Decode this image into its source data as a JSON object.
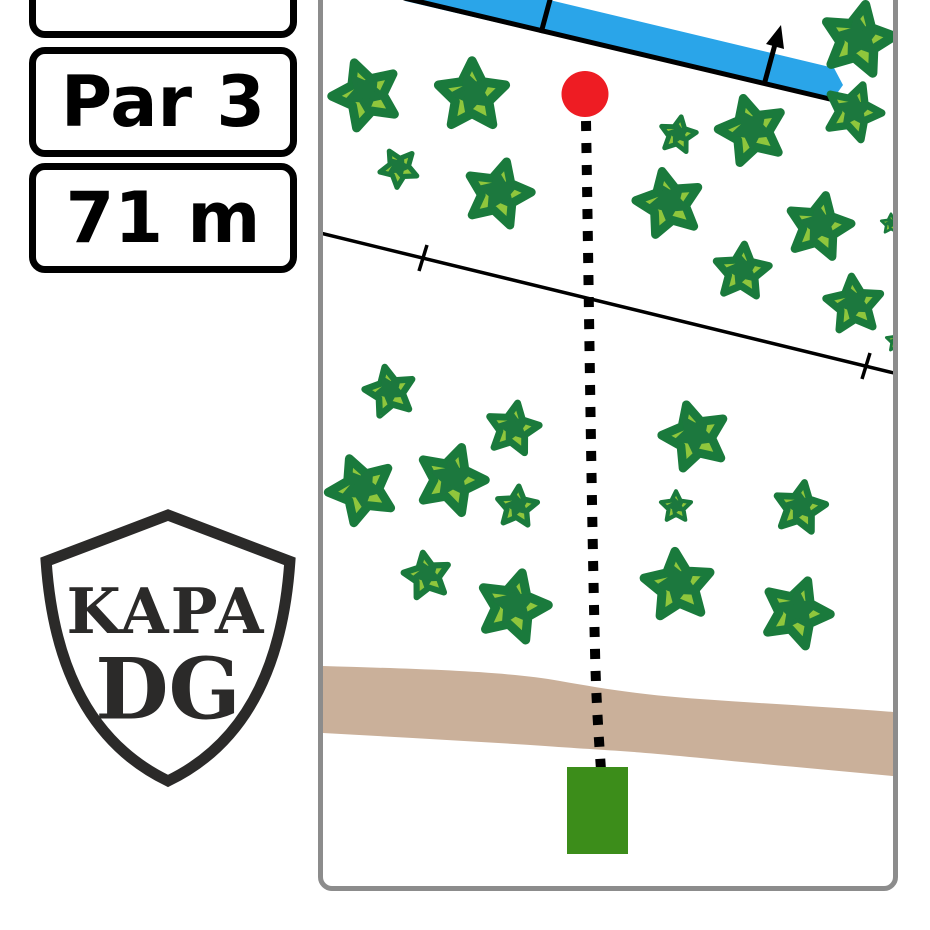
{
  "info_panel": {
    "hole_number_label": "",
    "par_label": "Par 3",
    "distance_label": "71 m"
  },
  "logo": {
    "line1": "KAPA",
    "line2": "DG"
  },
  "map": {
    "colors": {
      "tree_fill": "#8fc63c",
      "tree_outline": "#1a7a3c",
      "tree_inner": "#1c783e",
      "basket": "#ee1c23",
      "water": "#2aa5e9",
      "path": "#cab09a",
      "tee": "#3c8d1a",
      "map_border": "#8c8c8c",
      "line": "#000000"
    },
    "basket": {
      "x": 585,
      "y": 94,
      "rx": 23.5,
      "ry": 23
    },
    "tee_pad": {
      "x": 567,
      "y": 767,
      "w": 61,
      "h": 87
    },
    "trees": [
      {
        "x": 366,
        "y": 95,
        "size": 74,
        "rot": -20
      },
      {
        "x": 472,
        "y": 96,
        "size": 76,
        "rot": 0
      },
      {
        "x": 858,
        "y": 40,
        "size": 78,
        "rot": 12
      },
      {
        "x": 678,
        "y": 135,
        "size": 40,
        "rot": 10
      },
      {
        "x": 752,
        "y": 131,
        "size": 73,
        "rot": -15
      },
      {
        "x": 853,
        "y": 112,
        "size": 62,
        "rot": 20
      },
      {
        "x": 399,
        "y": 168,
        "size": 42,
        "rot": -30
      },
      {
        "x": 498,
        "y": 194,
        "size": 72,
        "rot": 15
      },
      {
        "x": 669,
        "y": 204,
        "size": 72,
        "rot": -12
      },
      {
        "x": 819,
        "y": 227,
        "size": 70,
        "rot": 12
      },
      {
        "x": 742,
        "y": 272,
        "size": 60,
        "rot": 5
      },
      {
        "x": 854,
        "y": 305,
        "size": 62,
        "rot": -5
      },
      {
        "x": 390,
        "y": 392,
        "size": 55,
        "rot": -12
      },
      {
        "x": 513,
        "y": 429,
        "size": 57,
        "rot": 10
      },
      {
        "x": 695,
        "y": 437,
        "size": 72,
        "rot": -15
      },
      {
        "x": 362,
        "y": 490,
        "size": 73,
        "rot": -22
      },
      {
        "x": 451,
        "y": 480,
        "size": 74,
        "rot": 18
      },
      {
        "x": 517,
        "y": 507,
        "size": 45,
        "rot": 5
      },
      {
        "x": 676,
        "y": 507,
        "size": 34,
        "rot": 0
      },
      {
        "x": 800,
        "y": 508,
        "size": 56,
        "rot": 10
      },
      {
        "x": 427,
        "y": 576,
        "size": 51,
        "rot": -10
      },
      {
        "x": 513,
        "y": 607,
        "size": 76,
        "rot": 15
      },
      {
        "x": 678,
        "y": 586,
        "size": 75,
        "rot": -5
      },
      {
        "x": 796,
        "y": 613,
        "size": 74,
        "rot": 20
      },
      {
        "x": 891,
        "y": 224,
        "size": 22,
        "rot": 0
      },
      {
        "x": 897,
        "y": 341,
        "size": 24,
        "rot": 0
      }
    ]
  }
}
